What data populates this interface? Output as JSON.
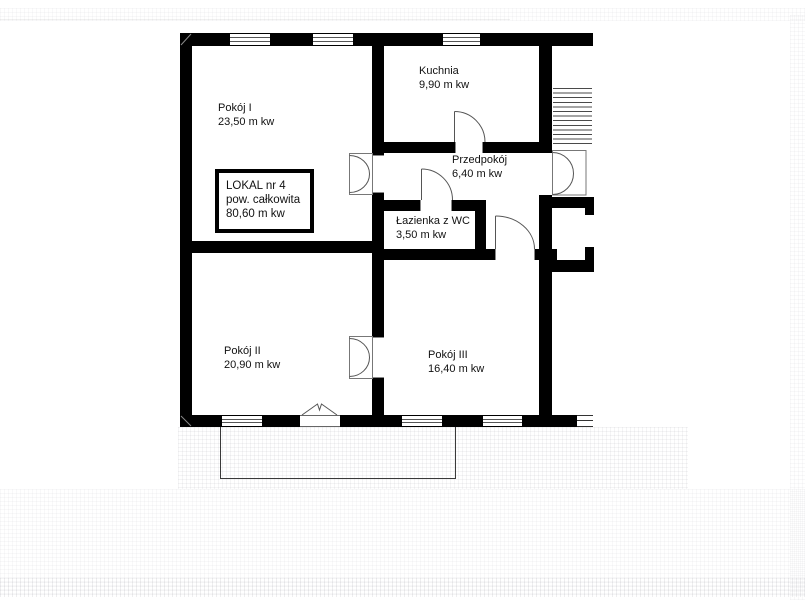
{
  "plan": {
    "unit": {
      "line1": "LOKAL nr 4",
      "line2": "pow. całkowita",
      "line3": "80,60 m kw"
    },
    "rooms": [
      {
        "id": "pokoj-i",
        "name": "Pokój I",
        "area": "23,50 m kw"
      },
      {
        "id": "kuchnia",
        "name": "Kuchnia",
        "area": "9,90 m kw"
      },
      {
        "id": "przedpokoj",
        "name": "Przedpokój",
        "area": "6,40 m kw"
      },
      {
        "id": "lazienka",
        "name": "Łazienka z WC",
        "area": "3,50 m kw"
      },
      {
        "id": "pokoj-ii",
        "name": "Pokój II",
        "area": "20,90 m kw"
      },
      {
        "id": "pokoj-iii",
        "name": "Pokój III",
        "area": "16,40 m kw"
      }
    ],
    "colors": {
      "wall": "#000000",
      "background": "#ffffff",
      "thin_line": "#444444"
    }
  }
}
